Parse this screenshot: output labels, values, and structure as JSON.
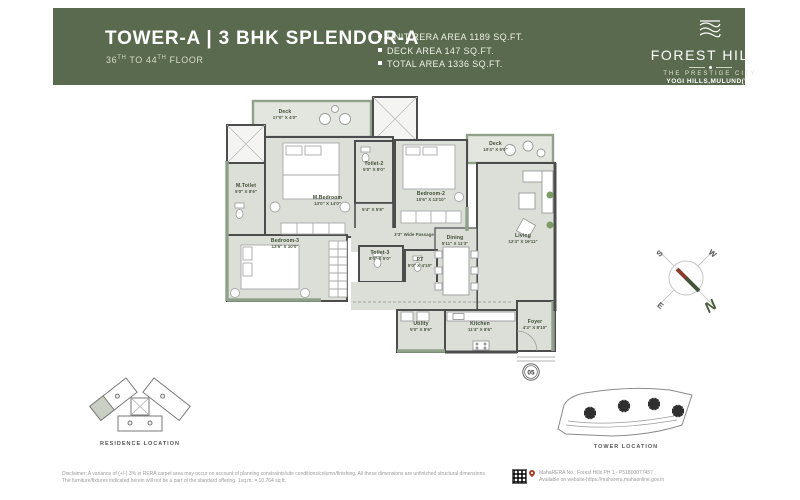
{
  "colors": {
    "header_green": "#5a6a4e",
    "plan_fill": "#dcdfd8",
    "wall_dark": "#4c4c4c",
    "wall_green": "#8fa189",
    "label_green": "#39482f",
    "compass_n_green": "#4a5d3a",
    "pin_red": "#a8402f"
  },
  "header": {
    "title": "TOWER-A | 3 BHK SPLENDOR-A",
    "floors": {
      "p1": "36",
      "s1": "TH",
      "p2": " TO 44",
      "s2": "TH",
      "p3": " FLOOR"
    },
    "areas": [
      "UNIT RERA AREA 1189 SQ.FT.",
      "DECK AREA  147 SQ.FT.",
      "TOTAL AREA 1336 SQ.FT."
    ],
    "logo": {
      "name": "FOREST HILLS",
      "sub1": "THE PRESTIGE CITY",
      "sub2": "YOGI HILLS,MULUND(W)"
    }
  },
  "plan": {
    "rooms": [
      {
        "name": "Deck",
        "dims": "17'0\" X 4'0\""
      },
      {
        "name": "M.Toilet",
        "dims": "5'0\" X 8'6\""
      },
      {
        "name": "M.Bedroom",
        "dims": "13'0\" X 14'0\""
      },
      {
        "name": "Toilet-2",
        "dims": "5'0\" X 8'0\""
      },
      {
        "name": "",
        "dims": "5'4\" X 5'8\""
      },
      {
        "name": "Bedroom-2",
        "dims": "10'6\" X 13'10\""
      },
      {
        "name": "Deck",
        "dims": "10'4\" X 5'0\""
      },
      {
        "name": "Living",
        "dims": "12'4\" X 19'11\""
      },
      {
        "name": "Dining",
        "dims": "5'11\" X 11'3\""
      },
      {
        "name": "Bedroom-3",
        "dims": "13'6\" X 10'0\""
      },
      {
        "name": "Toilet-3",
        "dims": "8'0\" X 5'0\""
      },
      {
        "name": "PT",
        "dims": "5'0\" X 4'10\""
      },
      {
        "name": "Utility",
        "dims": "5'0\" X 8'6\""
      },
      {
        "name": "Kitchen",
        "dims": "11'4\" X 8'6\""
      },
      {
        "name": "Foyer",
        "dims": "4'3\" X 8'10\""
      }
    ],
    "passage": "3'3\" Wide Passage",
    "unit_number": "05"
  },
  "compass": {
    "n": "N",
    "s": "S",
    "e": "E",
    "w": "W"
  },
  "locations": {
    "residence": "RESIDENCE LOCATION",
    "tower": "TOWER LOCATION"
  },
  "footer": {
    "disclaimer1": "Disclaimer: A variance of (+/-) 3% in RERA carpet area may occur on account of planning constraints/site conditions/column/finishing. All these dimensions are unfinished structural dimensions.",
    "disclaimer2": "The furniture/fixtures indicated herein will not be a part of the standard offering. 1sq.m. = 10.764 sq.ft.",
    "rera1": "MahaRERA No.: Forest Hills PH 1 - P51800077457",
    "rera2": "Available on website-https://maharera.mahaonline.gov.in"
  }
}
